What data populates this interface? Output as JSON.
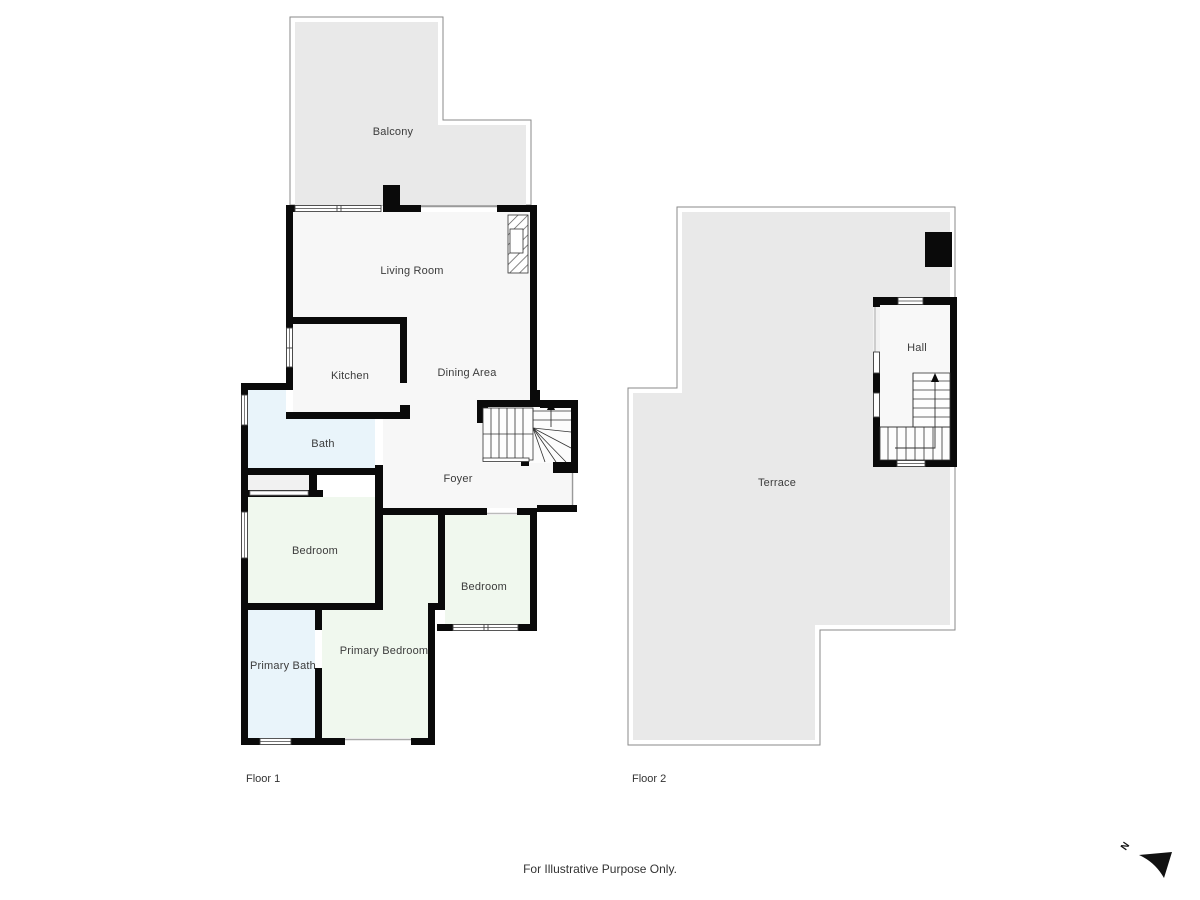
{
  "floor1": {
    "label": "Floor 1",
    "rooms": {
      "balcony": "Balcony",
      "living_room": "Living Room",
      "kitchen": "Kitchen",
      "dining_area": "Dining Area",
      "bath": "Bath",
      "foyer": "Foyer",
      "bedroom_1": "Bedroom",
      "bedroom_2": "Bedroom",
      "primary_bath": "Primary Bath",
      "primary_bedroom": "Primary Bedroom"
    }
  },
  "floor2": {
    "label": "Floor 2",
    "rooms": {
      "terrace": "Terrace",
      "hall": "Hall"
    }
  },
  "footer": {
    "disclaimer": "For Illustrative Purpose Only."
  },
  "compass": {
    "north": "N"
  },
  "colors": {
    "wall": "#0a0a0a",
    "outdoor_fill": "#e9e9e9",
    "outdoor_outline": "#8a8a8a",
    "interior_fill": "#f7f7f7",
    "bath_fill": "#e9f4fa",
    "bedroom_fill": "#f0f8ee",
    "closet_fill": "#f1f1f1",
    "label_text": "#3c3c3c"
  }
}
